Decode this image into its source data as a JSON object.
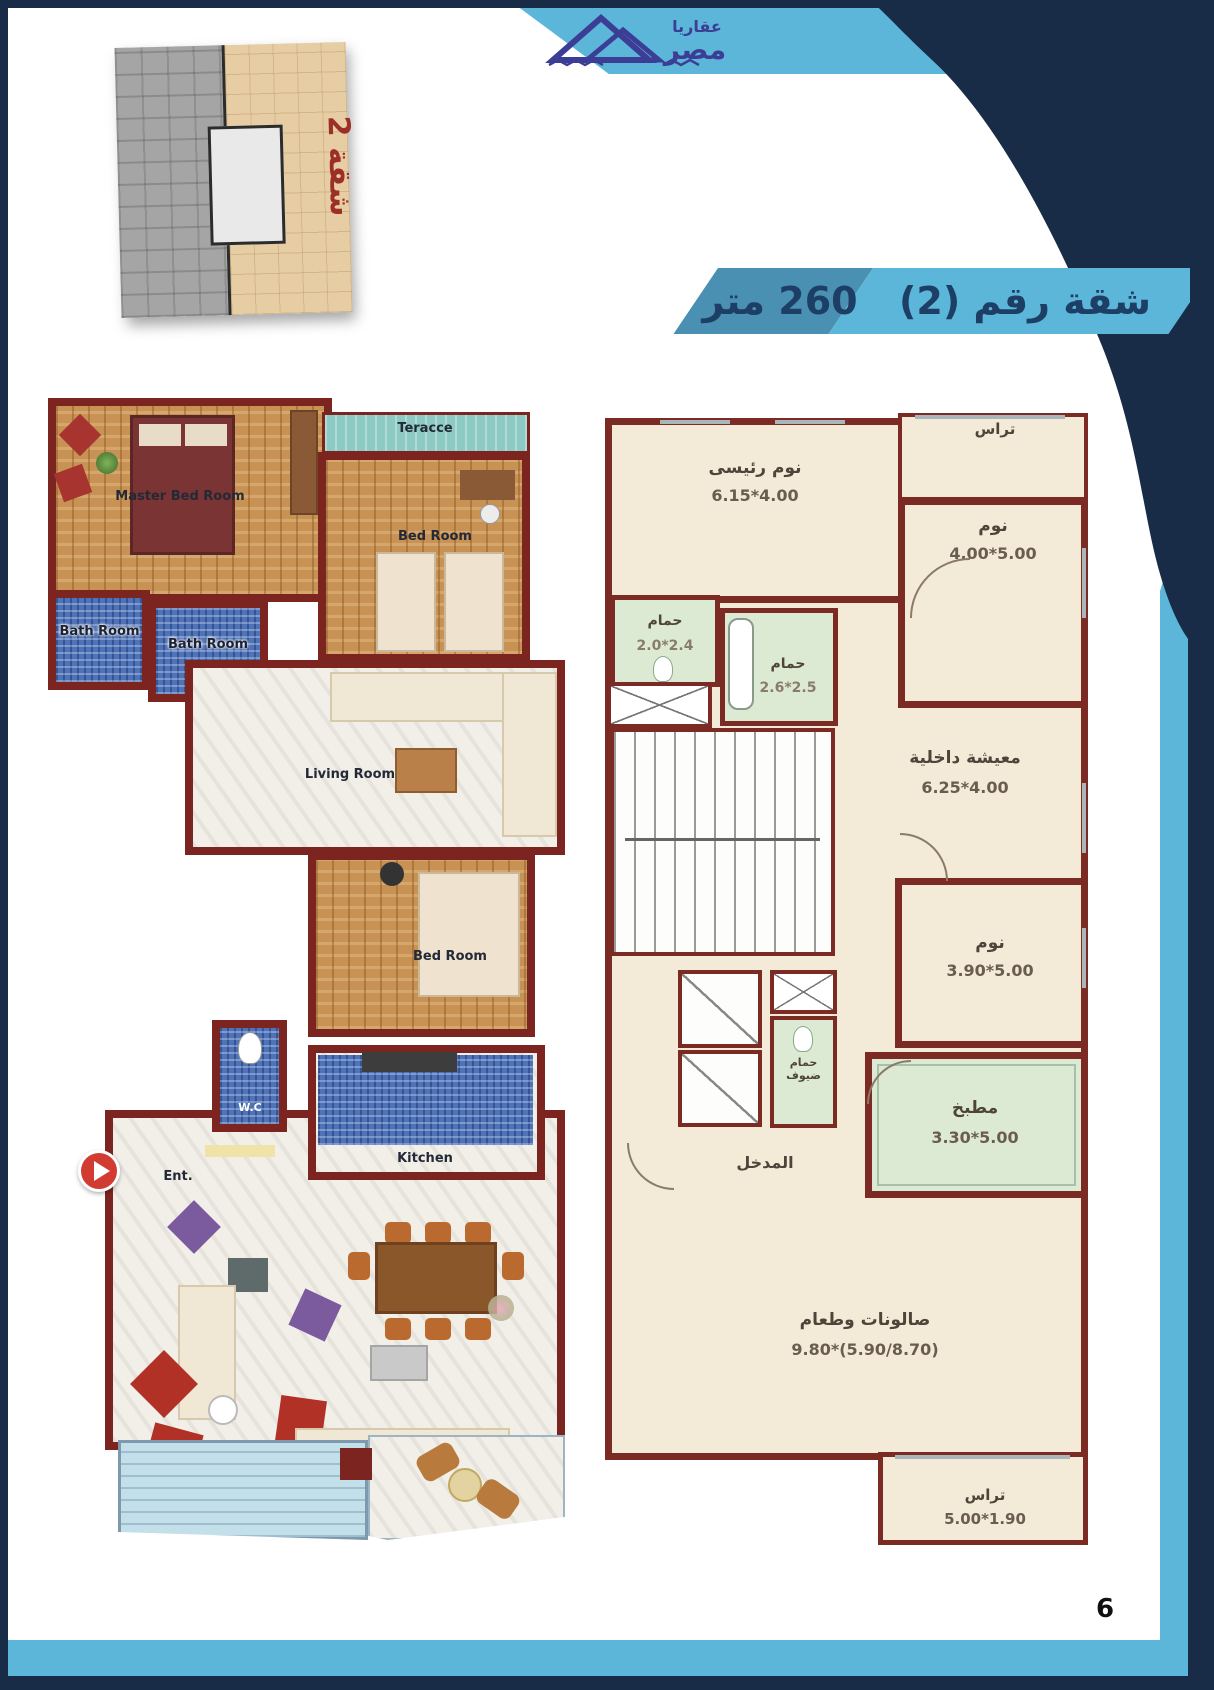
{
  "page": {
    "number": "6"
  },
  "logo": {
    "word_top": "عقاريا",
    "word_bottom": "مصر"
  },
  "header": {
    "apartment_title": "شقة رقم (2)",
    "area_label": "260 متر"
  },
  "inset": {
    "apartment_label": "شقة 2"
  },
  "left_plan": {
    "labels": {
      "master_bedroom": "Master Bed Room",
      "terrace": "Teracce",
      "bedroom_top": "Bed Room",
      "bathroom_left": "Bath Room",
      "bathroom_mid": "Bath Room",
      "living_room": "Living Room",
      "bedroom_mid": "Bed Room",
      "wc": "W.C",
      "kitchen": "Kitchen",
      "entrance": "Ent."
    }
  },
  "right_plan": {
    "rooms": {
      "terrace_top": {
        "name": "تراس"
      },
      "master_bedroom": {
        "name": "نوم رئيسى",
        "dims": "6.15*4.00"
      },
      "bedroom_right": {
        "name": "نوم",
        "dims": "4.00*5.00"
      },
      "bathroom_1": {
        "name": "حمام",
        "dims": "2.0*2.4"
      },
      "bathroom_2": {
        "name": "حمام",
        "dims": "2.6*2.5"
      },
      "inner_living": {
        "name": "معيشة داخلية",
        "dims": "6.25*4.00"
      },
      "bedroom_mid": {
        "name": "نوم",
        "dims": "3.90*5.00"
      },
      "guest_bathroom": {
        "name": "حمام ضيوف"
      },
      "kitchen": {
        "name": "مطبخ",
        "dims": "3.30*5.00"
      },
      "entrance": {
        "name": "المدخل"
      },
      "salon_dining": {
        "name": "صالونات وطعام",
        "dims": "9.80*(5.90/8.70)"
      },
      "terrace_bottom": {
        "name": "تراس",
        "dims": "5.00*1.90"
      }
    }
  },
  "colors": {
    "navy": "#182c47",
    "sky_blue": "#5cb6da",
    "mid_blue": "#4a90b2",
    "wall_maroon": "#7c2822",
    "floor_cream": "#f3ead8",
    "wet_green": "#dcead3",
    "title_text": "#1d3f66",
    "inset_red": "#9c2f28"
  }
}
